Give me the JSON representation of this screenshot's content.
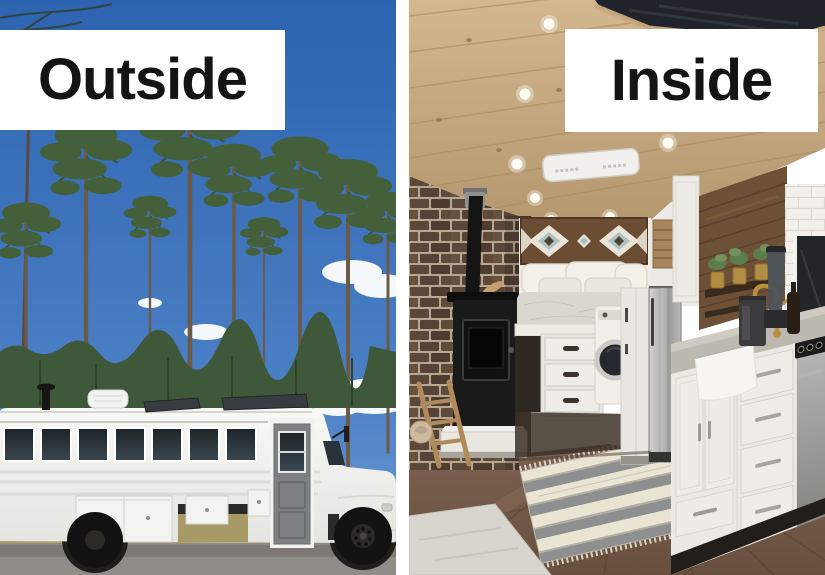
{
  "comparison": {
    "left_panel": {
      "label": "Outside",
      "scene": "white converted school bus parked on a road in front of tall pine trees under a blue sky"
    },
    "right_panel": {
      "label": "Inside",
      "scene": "renovated bus interior with wood ceiling, brick wall, wood stove, bed nook, laundry, kitchen"
    }
  },
  "palette": {
    "label_background": "#ffffff",
    "label_text": "#141414",
    "sky_blue": "#3a6fb5",
    "pine_green": "#43603a",
    "bus_white": "#f4f4f1",
    "road_gray": "#8f8d88",
    "ceiling_wood": "#c5a77e",
    "brick_brown": "#5c483a",
    "cabinet_white": "#ebe9e4",
    "floor_brown": "#74594a",
    "rug_gray": "#8d8f91",
    "rug_cream": "#eae4d3",
    "faucet_gold": "#b8913e"
  },
  "scene_elements": {
    "left": [
      "blue-sky",
      "clouds",
      "pine-trees",
      "treeline",
      "white-school-bus",
      "bus-windows",
      "entry-door",
      "roof-solar-panels",
      "roof-vent",
      "storage-boxes",
      "wheels",
      "road"
    ],
    "right": [
      "wood-plank-ceiling",
      "recessed-lights",
      "roof-hatch",
      "ceiling-vent-unit",
      "brick-accent-wall",
      "wood-stove",
      "stove-pipe",
      "ladder",
      "bed-nook",
      "geometric-wood-art",
      "pillows",
      "under-bed-drawers",
      "washing-machine",
      "stainless-fridge",
      "wood-accent-wall",
      "plant-shelf",
      "subway-tile",
      "window",
      "countertop",
      "farmhouse-sink",
      "gold-faucet",
      "coffee-maker",
      "kitchen-cabinets",
      "range-oven",
      "wood-floor",
      "striped-rug",
      "floor-mat"
    ]
  }
}
